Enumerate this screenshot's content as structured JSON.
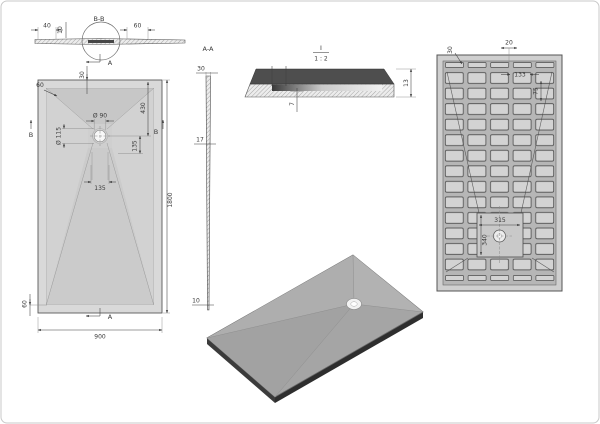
{
  "drawing_type": "shower-tray-technical-drawing",
  "section_bb": {
    "label": "B-B",
    "dim_40": "40",
    "dim_10": "10",
    "dim_60": "60",
    "cut_a": "A"
  },
  "front": {
    "dim_rim_top": "60",
    "dim_top": "30",
    "dim_drain_dia": "Ø 90",
    "dim_recess_dia": "Ø 115",
    "dim_430": "430",
    "dim_135_right": "135",
    "dim_135_bottom": "135",
    "dim_height": "1800",
    "dim_width": "900",
    "dim_rim_bottom": "60",
    "cut_b_left": "B",
    "cut_b_right": "B",
    "cut_a_top": "A",
    "cut_a_bottom": "A"
  },
  "side_aa": {
    "label": "A-A",
    "dim_top": "30",
    "dim_mid": "17",
    "dim_bottom": "10"
  },
  "detail_i": {
    "label": "I",
    "scale": "1 : 2",
    "dim_7": "7",
    "dim_13": "13"
  },
  "bottom": {
    "dim_30": "30",
    "dim_20": "20",
    "dim_133": "133",
    "dim_75": "75",
    "dim_315": "315",
    "dim_340": "340"
  },
  "colors": {
    "line": "#3f3f3f",
    "rim": "#d9d9d9",
    "face": "#cfcfcf",
    "slope_dark": "#c7c7c7",
    "detail_dark": "#4e4e4e",
    "grid_bg": "#b6b6b6",
    "cell": "#d3d3d3",
    "iso_face": "#a8a8a8"
  }
}
